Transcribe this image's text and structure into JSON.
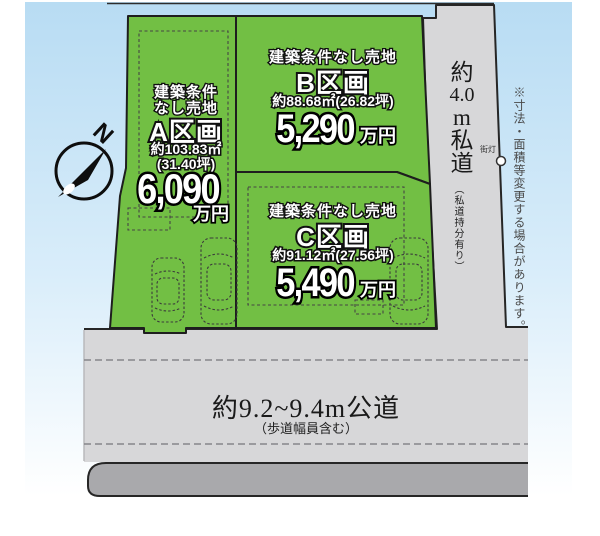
{
  "compass": {
    "label": "N"
  },
  "disclaimer": "※寸法・面積等変更する場合があります。",
  "parcels": {
    "a": {
      "condition_line1": "建築条件",
      "condition_line2": "なし売地",
      "name": "A区画",
      "area": "約103.83㎡",
      "area_tsubo": "(31.40坪)",
      "price": "6,090",
      "price_unit": "万円"
    },
    "b": {
      "condition": "建築条件なし売地",
      "name": "B区画",
      "area": "約88.68㎡(26.82坪)",
      "price": "5,290",
      "price_unit": "万円"
    },
    "c": {
      "condition": "建築条件なし売地",
      "name": "C区画",
      "area": "約91.12㎡(27.56坪)",
      "price": "5,490",
      "price_unit": "万円"
    }
  },
  "roads": {
    "private": {
      "label": "約4.0m私道",
      "label_parts": [
        "約",
        "4.0",
        "m",
        "私",
        "道"
      ],
      "note": "（私道持分有り）",
      "streetlight": "街灯"
    },
    "public": {
      "label": "約9.2~9.4m公道",
      "note": "（歩道幅員含む）"
    }
  },
  "colors": {
    "parcel_green": "#72bf44",
    "road_gray": "#d7d7d9",
    "sidewalk_gray": "#a9a9ac",
    "sky_top": "#b8dcf3",
    "outline_dark": "#262626"
  }
}
